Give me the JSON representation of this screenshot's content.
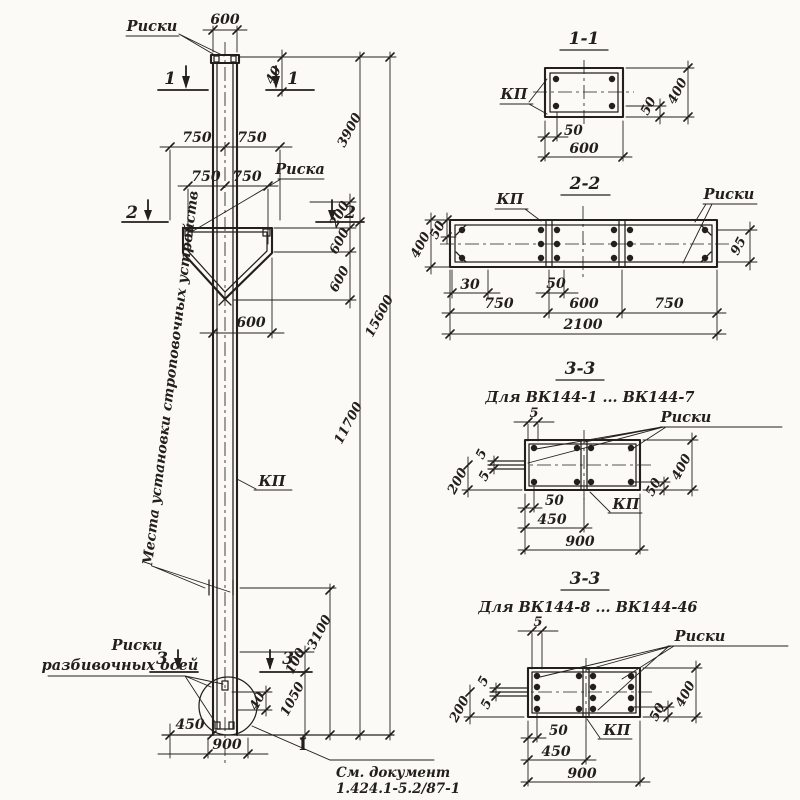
{
  "sheet": {
    "paper_color": "#fbfaf7",
    "ink_color": "#23201c"
  },
  "elevation": {
    "labels": {
      "riski_top": "Риски",
      "riska": "Риска",
      "kp": "КП",
      "lifting_note": "Места установки строповочных устройств",
      "axes_note_line1": "Риски",
      "axes_note_line2": "разбивочных осей"
    },
    "section_marks": {
      "s1": "1",
      "s2": "2",
      "s3": "3"
    },
    "dims": {
      "top_width": "600",
      "head_offset": "40",
      "row1_left": "750",
      "row1_right": "750",
      "row2_left": "750",
      "row2_right": "750",
      "corbel_top": "200",
      "corbel_mid": "600",
      "corbel_bottom": "600",
      "shaft_width": "600",
      "foot_offset": "40",
      "foot_half": "450",
      "foot_width": "900",
      "mark_to_section": "100",
      "embed_depth": "1050",
      "lift_height": "3100",
      "top_part": "3900",
      "shaft_part": "11700",
      "total_length": "15600"
    },
    "note": {
      "symbol": "I",
      "line1": "См. документ",
      "line2": "1.424.1-5.2/87-1"
    }
  },
  "section11": {
    "title": "1-1",
    "kp": "КП",
    "dims": {
      "cover": "50",
      "width": "600",
      "side_cover": "50",
      "height": "400"
    }
  },
  "section22": {
    "title": "2-2",
    "kp": "КП",
    "riski": "Риски",
    "dims": {
      "height": "400",
      "top_cover": "50",
      "right_cover": "95",
      "edge": "30",
      "mid_cover": "50",
      "left": "750",
      "center": "600",
      "right": "750",
      "total": "2100"
    }
  },
  "section33a": {
    "title": "3-3",
    "subtitle": "Для ВК144-1 ... ВК144-7",
    "kp": "КП",
    "riski": "Риски",
    "dims": {
      "top_offset": "5",
      "gap_upper": "5",
      "gap_lower": "5",
      "left_offset": "200",
      "cover": "50",
      "half": "450",
      "width": "900",
      "side_cover": "50",
      "height": "400"
    }
  },
  "section33b": {
    "title": "3-3",
    "subtitle": "Для ВК144-8 ... ВК144-46",
    "kp": "КП",
    "riski": "Риски",
    "dims": {
      "top_offset": "5",
      "gap_upper": "5",
      "gap_lower": "5",
      "left_offset": "200",
      "cover": "50",
      "half": "450",
      "width": "900",
      "side_cover": "50",
      "height": "400"
    }
  }
}
